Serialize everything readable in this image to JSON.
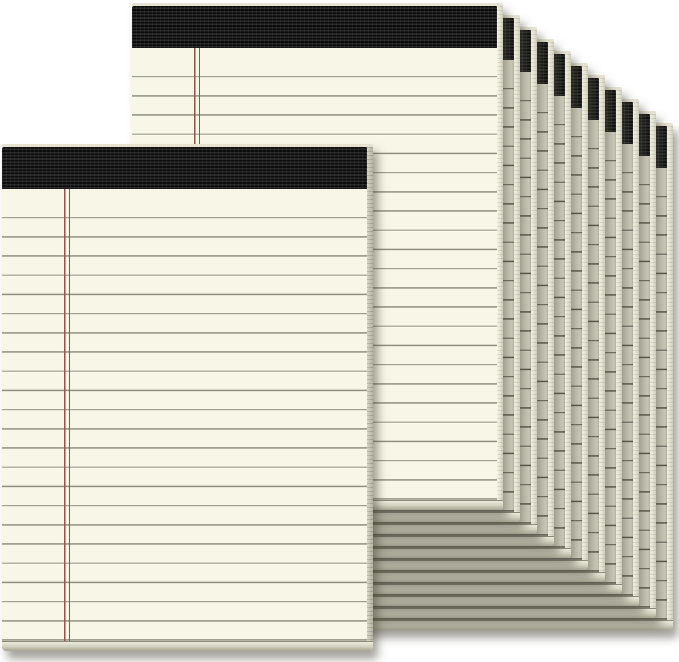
{
  "scene": {
    "description": "Product photo: a 12-pack of ivory cream legal pads with black tape bindings, ruled gray lines and a double red left margin line; two pads shown face-on in front (one lower-left, one upper-middle) and ten more pads fanned diagonally behind them toward the lower right on a white background",
    "background": "#ffffff",
    "pad_count_total": 12,
    "front_pad_count": 2,
    "fan_pad_count": 10
  },
  "colors": {
    "background": "#ffffff",
    "paper_front": "#f8f6e6",
    "paper_fan": "#e7e5d3",
    "rule_line_front": "#8f8e7d",
    "rule_line_fan": "#5e5d4f",
    "line_highlight": "#fffef2",
    "margin_line_red": "#93544b",
    "binding_dark": "#0c0c0c",
    "binding_light": "#272727",
    "top_edge": "#e6e3d2",
    "side_front_light": "#f8f6e8",
    "side_front_dark": "#cfcdbb",
    "side_shaded_light": "#d8d6c4",
    "side_shaded_dark": "#b4b2a0",
    "bottom_edge_light": "#eceadb",
    "bottom_edge_dark": "#a7a592",
    "shadow": "rgba(76,74,60,0.5)"
  },
  "geometry": {
    "canvas_width": 679,
    "canvas_height": 662,
    "pad_width": 371,
    "pad_height": 507,
    "binding_height": 42,
    "top_edge_height": 3,
    "bottom_edge_height": 9,
    "side_edge_width": 6,
    "rule_spacing": 19.2,
    "rule_thickness": 1.3,
    "first_rule_offset": 28,
    "margin_line_x": 62,
    "front_pad_x": 2,
    "front_pad_y": 144,
    "second_pad_x": 132,
    "second_pad_y": 3,
    "fan_offset_x": 17,
    "fan_offset_y": 12
  }
}
